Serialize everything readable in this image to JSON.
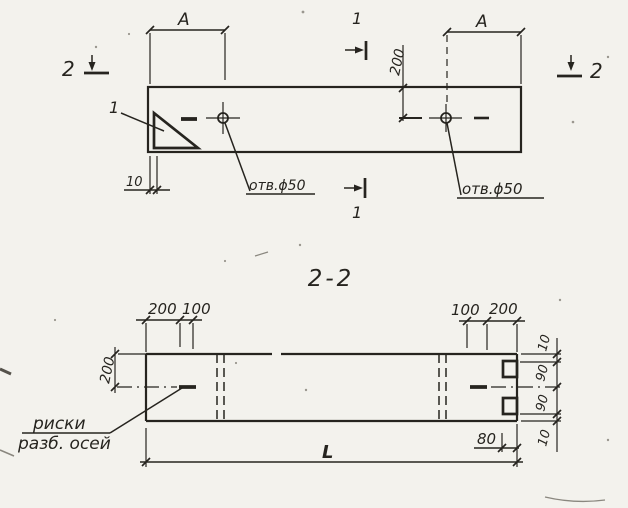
{
  "drawing": {
    "plan": {
      "dim_a_left": "A",
      "dim_a_right": "A",
      "dim_200": "200",
      "dim_10": "10",
      "hole_label_left": "отв.ϕ50",
      "hole_label_right": "отв.ϕ50",
      "corner_detail_label": "1",
      "section_1_label_top": "1",
      "section_1_label_bottom": "1",
      "section_2_label_left": "2",
      "section_2_label_right": "2"
    },
    "section": {
      "title": "2-2",
      "dim_top_left_200": "200",
      "dim_top_left_100": "100",
      "dim_top_right_100": "100",
      "dim_top_right_200": "200",
      "dim_left_height": "200",
      "dim_right_10_top": "10",
      "dim_right_90_top": "90",
      "dim_right_90_bottom": "90",
      "dim_right_10_bottom": "10",
      "dim_80": "80",
      "dim_length": "L",
      "note_line1": "риски",
      "note_line2": "разб. осей"
    },
    "colors": {
      "ink": "#26241f",
      "paper": "#f3f2ed"
    }
  }
}
